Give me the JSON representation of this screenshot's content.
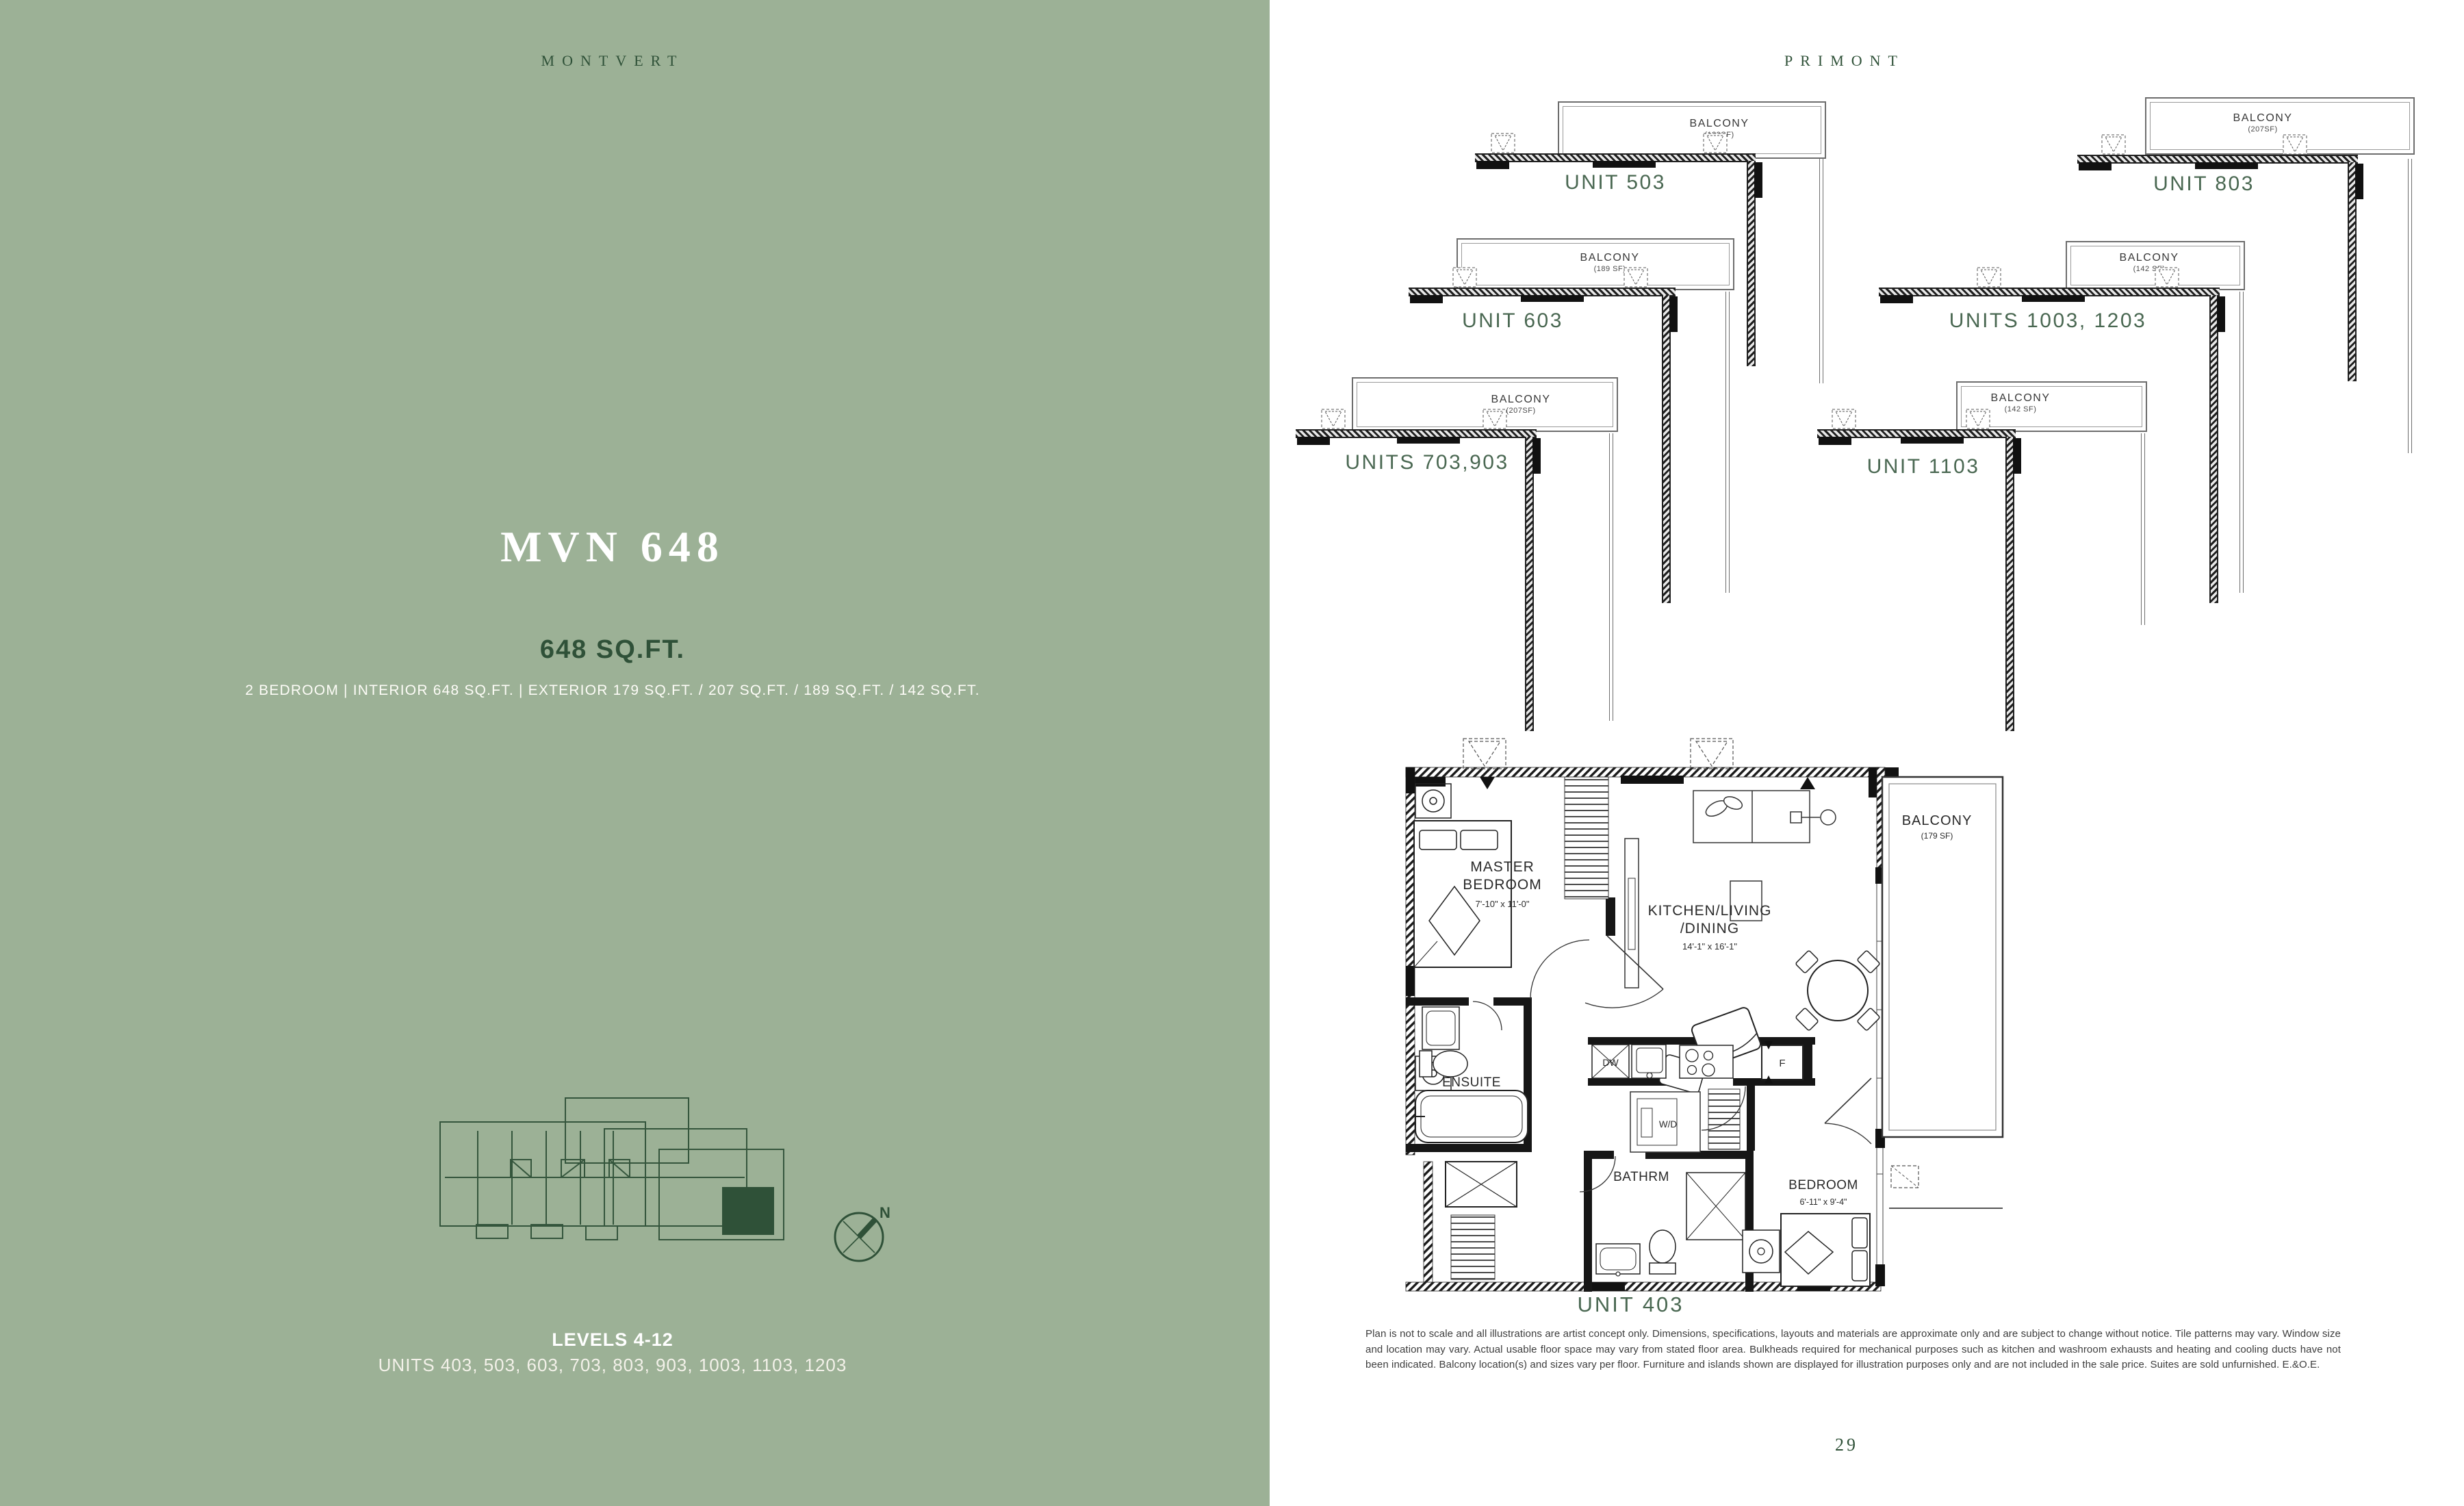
{
  "page": {
    "number": "29"
  },
  "colors": {
    "background_green": "#9cb196",
    "dark_green": "#2f5138",
    "unit_label_green": "#4a6852",
    "plan_line": "#1f1f1f",
    "highlight_unit_fill": "#2f5138"
  },
  "left_panel": {
    "brand": "MONTVERT",
    "title": "MVN 648",
    "sqft": "648 SQ.FT.",
    "details": "2 BEDROOM  |  INTERIOR 648 SQ.FT.  |  EXTERIOR 179 SQ.FT. / 207 SQ.FT. / 189 SQ.FT. / 142 SQ.FT.",
    "levels": "LEVELS 4-12",
    "units": "UNITS 403, 503, 603, 703, 803, 903, 1003, 1103, 1203",
    "compass_north": "N"
  },
  "right_panel": {
    "brand": "PRIMONT",
    "mini_plans": [
      {
        "label": "UNIT 503",
        "balcony_label": "BALCONY",
        "balcony_area": "(189SF)"
      },
      {
        "label": "UNIT 803",
        "balcony_label": "BALCONY",
        "balcony_area": "(207SF)"
      },
      {
        "label": "UNIT 603",
        "balcony_label": "BALCONY",
        "balcony_area": "(189 SF)"
      },
      {
        "label": "UNITS 1003, 1203",
        "balcony_label": "BALCONY",
        "balcony_area": "(142 SF)"
      },
      {
        "label": "UNITS 703,903",
        "balcony_label": "BALCONY",
        "balcony_area": "(207SF)"
      },
      {
        "label": "UNIT 1103",
        "balcony_label": "BALCONY",
        "balcony_area": "(142 SF)"
      }
    ],
    "main_plan": {
      "unit_label": "UNIT 403",
      "rooms": {
        "master_bedroom": {
          "line1": "MASTER",
          "line2": "BEDROOM",
          "dims": "7'-10\" x 11'-0\""
        },
        "kitchen": {
          "line1": "KITCHEN/LIVING",
          "line2": "/DINING",
          "dims": "14'-1\" x 16'-1\""
        },
        "balcony": {
          "label": "BALCONY",
          "area": "(179 SF)"
        },
        "ensuite": {
          "label": "ENSUITE"
        },
        "bathroom": {
          "label": "BATHRM"
        },
        "bedroom": {
          "label": "BEDROOM",
          "dims": "6'-11\" x 9'-4\""
        },
        "dishwasher": {
          "label": "DW"
        },
        "fridge": {
          "label": "F"
        },
        "washer_dryer": {
          "label": "W/D"
        }
      }
    },
    "disclaimer": "Plan is not to scale and all illustrations are artist concept only. Dimensions, specifications, layouts and materials are approximate only and are subject to change without notice. Tile patterns may vary. Window size and location may vary. Actual usable floor space may vary from stated floor area. Bulkheads required for mechanical purposes such as kitchen and washroom exhausts and heating and cooling ducts have not been indicated. Balcony location(s) and sizes vary per floor. Furniture and islands shown are displayed for illustration purposes only and are not included in the sale price. Suites are sold unfurnished. E.&O.E."
  }
}
